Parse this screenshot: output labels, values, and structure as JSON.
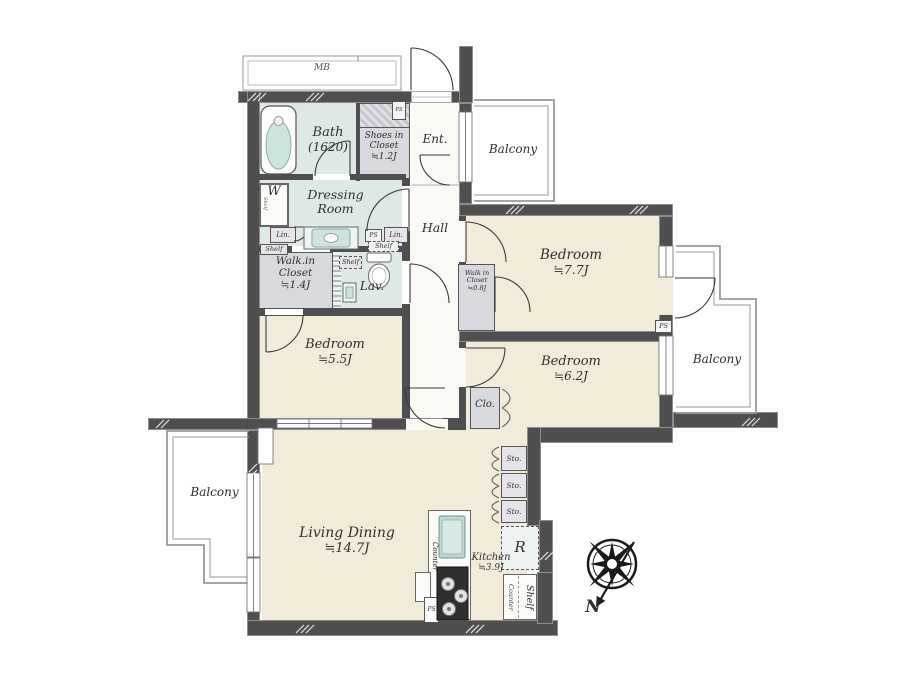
{
  "plan": {
    "meter_box": "MB",
    "compass_north": "N",
    "rooms": {
      "bath": {
        "name": "Bath",
        "size": "(1620)"
      },
      "shoes_closet": {
        "line1": "Shoes in",
        "line2": "Closet",
        "size": "≒1.2J"
      },
      "entrance": {
        "name": "Ent."
      },
      "dressing_room": {
        "line1": "Dressing",
        "line2": "Room"
      },
      "hall": {
        "name": "Hall"
      },
      "lavatory": {
        "name": "Lav."
      },
      "walk_in_closet_main": {
        "line1": "Walk.in",
        "line2": "Closet",
        "size": "≒1.4J"
      },
      "bedroom_1": {
        "name": "Bedroom",
        "size": "≒7.7J"
      },
      "walk_in_closet_small": {
        "line1": "Walk in",
        "line2": "Closet",
        "size": "≒0.8J"
      },
      "bedroom_2": {
        "name": "Bedroom",
        "size": "≒5.5J"
      },
      "bedroom_3": {
        "name": "Bedroom",
        "size": "≒6.2J"
      },
      "closet": {
        "name": "Clo."
      },
      "living_dining": {
        "name": "Living Dining",
        "size": "≒14.7J"
      },
      "kitchen": {
        "name": "Kitchen",
        "size": "≒3.9J"
      }
    },
    "balconies": {
      "top": "Balcony",
      "right": "Balcony",
      "left": "Balcony"
    },
    "fixtures": {
      "washer": "W",
      "linen": "Lin.",
      "shelf": "Shelf",
      "counter": "Counter",
      "storage": "Sto.",
      "refrigerator": "R",
      "pipe_space": "PS"
    },
    "colors": {
      "wall": "#4f4f4f",
      "floor": "#f1ebd9",
      "wet_floor": "#dfe9e4",
      "closet": "#d8d8df",
      "balcony_line": "#9a9a9a",
      "sink": "#bed8d3",
      "stove": "#2f2f2f",
      "text": "#2f2f2f"
    }
  }
}
